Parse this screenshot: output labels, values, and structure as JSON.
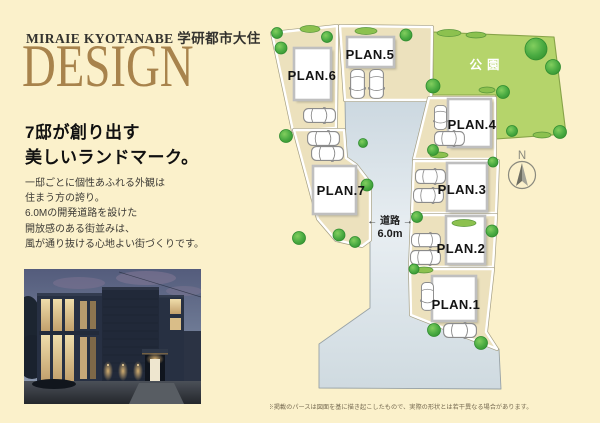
{
  "header": {
    "eyebrow": "MIRAIE KYOTANABE 学研都市大住",
    "title": "DESIGN"
  },
  "intro": {
    "heading": [
      "7邸が創り出す",
      "美しいランドマーク。"
    ],
    "body": [
      "一邸ごとに個性あふれる外観は",
      "住まう方の誇り。",
      "6.0Mの開発道路を設けた",
      "開放感のある街並みは、",
      "風が通り抜ける心地よい街づくりです。"
    ]
  },
  "siteplan": {
    "lots": [
      {
        "label": "PLAN.1"
      },
      {
        "label": "PLAN.2"
      },
      {
        "label": "PLAN.3"
      },
      {
        "label": "PLAN.4"
      },
      {
        "label": "PLAN.5"
      },
      {
        "label": "PLAN.6"
      },
      {
        "label": "PLAN.7"
      }
    ],
    "park_label": "公園",
    "road": {
      "label": "← 道路 →",
      "width": "6.0m"
    },
    "compass": "N",
    "disclaimer": "※掲載のパースは図面を基に描き起こしたもので、実際の形状とは若干異なる場合があります。"
  },
  "colors": {
    "background": "#fbf1cb",
    "title": "#a8834c",
    "park": "#b5d46b",
    "lot": "#ece1bd",
    "road": "#dde6ea",
    "tree": "#3fa23c"
  }
}
